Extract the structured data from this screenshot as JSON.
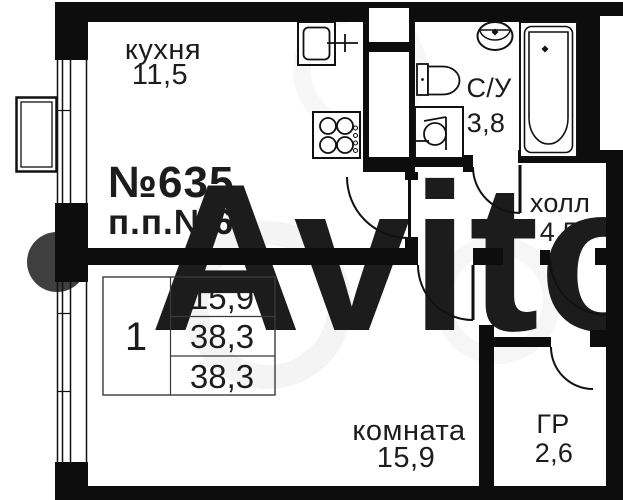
{
  "plan": {
    "apartment_number": "№635",
    "unit_label": "п.п.№6",
    "rooms": {
      "kitchen": {
        "name": "кухня",
        "area": "11,5"
      },
      "bathroom": {
        "name": "С/У",
        "area": "3,8"
      },
      "hall": {
        "name": "холл",
        "area": "4,5"
      },
      "living_room": {
        "name": "комната",
        "area": "15,9"
      },
      "wardrobe": {
        "name": "ГР",
        "area": "2,6"
      }
    },
    "summary_table": {
      "rooms_count": "1",
      "living_area": "15,9",
      "total_area": "38,3",
      "total_area_alt": "38,3"
    },
    "colors": {
      "wall_black": "#0d0d0d",
      "number_blue": "#21395b",
      "watermark_gray": "#3f3f3f"
    },
    "icons": [
      "kitchen-sink-icon",
      "stove-icon",
      "toilet-icon",
      "washing-machine-icon",
      "washbasin-icon",
      "bathtub-icon",
      "window-icon",
      "ac-unit-icon",
      "door-arc-icon"
    ]
  }
}
